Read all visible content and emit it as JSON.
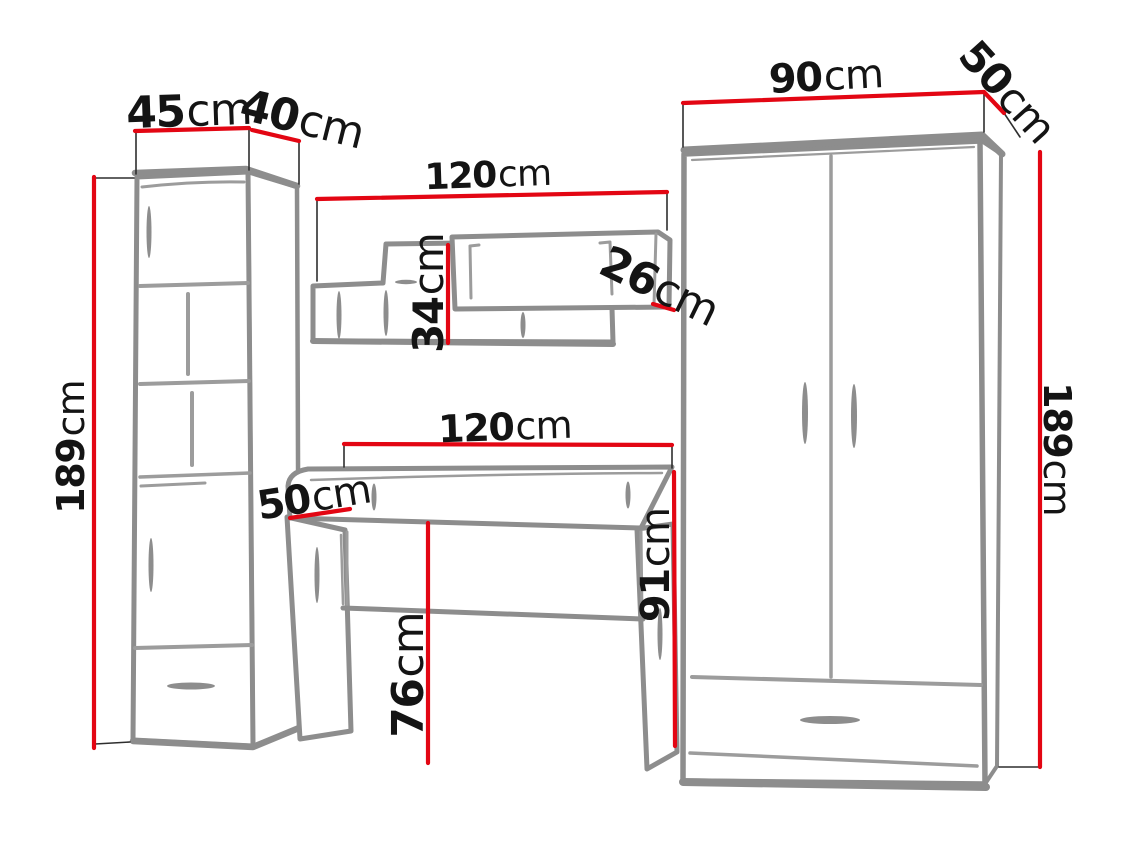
{
  "diagram": {
    "type": "furniture-dimension-drawing",
    "units": "cm",
    "furniture": [
      {
        "name": "tall-cabinet",
        "width_cm": 45,
        "depth_cm": 40,
        "height_cm": 189
      },
      {
        "name": "wall-shelf",
        "width_cm": 120,
        "height_cm": 34,
        "depth_cm": 26
      },
      {
        "name": "desk",
        "width_cm": 120,
        "depth_cm": 50,
        "height_cm": 91,
        "underside_height_cm": 76
      },
      {
        "name": "wardrobe",
        "width_cm": 90,
        "depth_cm": 50,
        "height_cm": 189
      }
    ]
  },
  "dimensions": {
    "cabinet_width": {
      "value": "45",
      "unit": "cm"
    },
    "cabinet_depth": {
      "value": "40",
      "unit": "cm"
    },
    "cabinet_height": {
      "value": "189",
      "unit": "cm"
    },
    "shelf_width": {
      "value": "120",
      "unit": "cm"
    },
    "shelf_height": {
      "value": "34",
      "unit": "cm"
    },
    "shelf_depth": {
      "value": "26",
      "unit": "cm"
    },
    "desk_width": {
      "value": "120",
      "unit": "cm"
    },
    "desk_depth": {
      "value": "50",
      "unit": "cm"
    },
    "desk_clearance": {
      "value": "76",
      "unit": "cm"
    },
    "desk_height": {
      "value": "91",
      "unit": "cm"
    },
    "wardrobe_width": {
      "value": "90",
      "unit": "cm"
    },
    "wardrobe_depth": {
      "value": "50",
      "unit": "cm"
    },
    "wardrobe_height": {
      "value": "189",
      "unit": "cm"
    }
  },
  "palette": {
    "background": "#ffffff",
    "dimension_line": "#e30613",
    "furniture_outline": "#8d8d8d",
    "furniture_detail": "#9c9c9c",
    "guide_line": "#2e2e2e",
    "label_text": "#141414"
  }
}
